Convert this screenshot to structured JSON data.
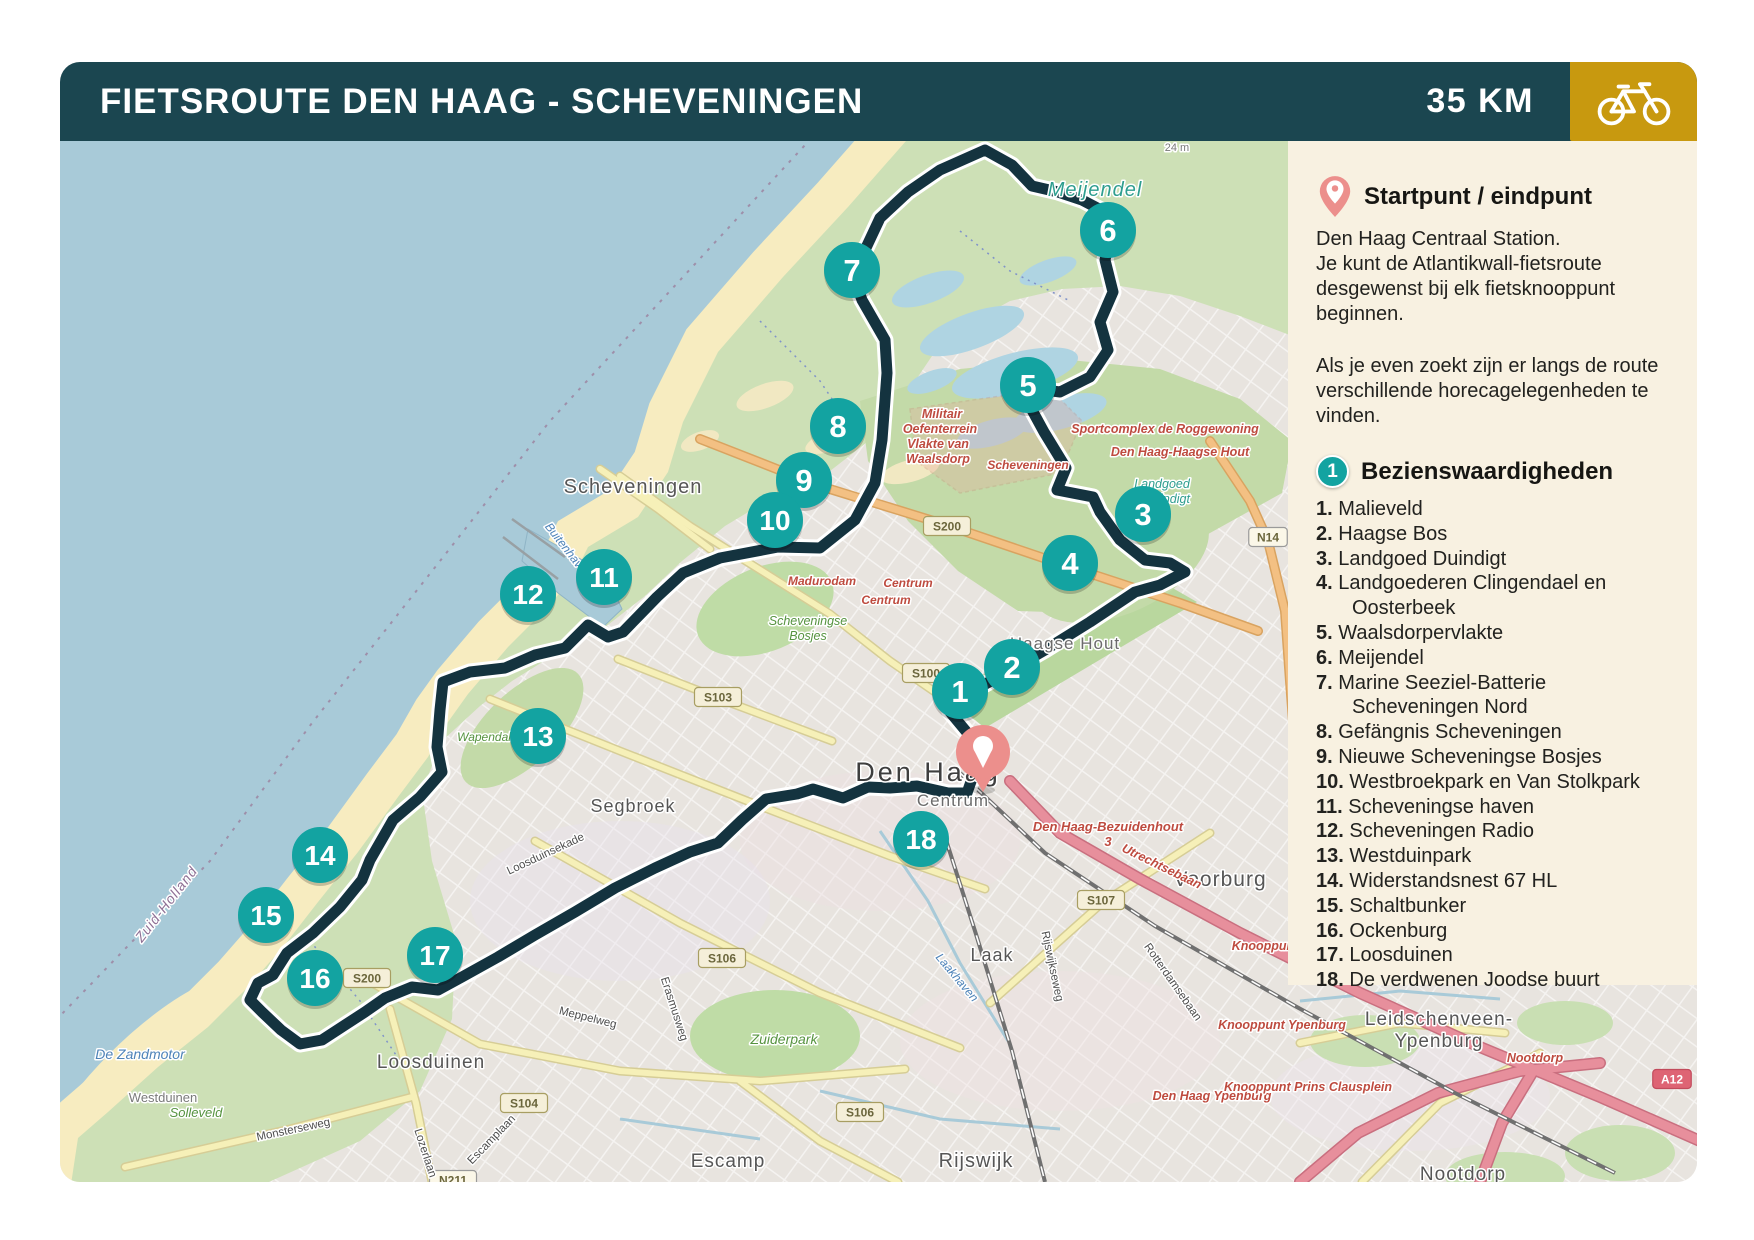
{
  "colors": {
    "header_teal": "#1B4650",
    "gold": "#C8990F",
    "marker_teal": "#13A3A1",
    "pin_salmon": "#EC8F8C",
    "route_navy": "#14333F",
    "panel_cream": "#F8F1E1"
  },
  "header": {
    "title": "FIETSROUTE DEN HAAG - SCHEVENINGEN",
    "distance": "35 KM",
    "icon": "bicycle-icon"
  },
  "sidebar": {
    "start_title": "Startpunt / eindpunt",
    "start_lines": [
      "Den Haag Centraal Station.",
      "Je kunt de Atlantikwall-fietsroute desgewenst bij elk fietsknooppunt beginnen."
    ],
    "note": "Als je even zoekt zijn er langs de route verschillende horecagelegenheden te vinden.",
    "sights_badge": "1",
    "sights_title": "Bezienswaardigheden",
    "sights": [
      {
        "n": "1.",
        "t": "Malieveld"
      },
      {
        "n": "2.",
        "t": "Haagse Bos"
      },
      {
        "n": "3.",
        "t": "Landgoed Duindigt"
      },
      {
        "n": "4.",
        "t": "Landgoederen Clingendael en Oosterbeek"
      },
      {
        "n": "5.",
        "t": "Waalsdorpervlakte"
      },
      {
        "n": "6.",
        "t": "Meijendel"
      },
      {
        "n": "7.",
        "t": "Marine Seeziel-Batterie Scheveningen Nord"
      },
      {
        "n": "8.",
        "t": "Gefängnis Scheveningen"
      },
      {
        "n": "9.",
        "t": "Nieuwe Scheveningse Bosjes"
      },
      {
        "n": "10.",
        "t": "Westbroekpark en Van Stolkpark"
      },
      {
        "n": "11.",
        "t": "Scheveningse haven"
      },
      {
        "n": "12.",
        "t": "Scheveningen Radio"
      },
      {
        "n": "13.",
        "t": "Westduinpark"
      },
      {
        "n": "14.",
        "t": "Widerstandsnest 67 HL"
      },
      {
        "n": "15.",
        "t": "Schaltbunker"
      },
      {
        "n": "16.",
        "t": "Ockenburg"
      },
      {
        "n": "17.",
        "t": "Loosduinen"
      },
      {
        "n": "18.",
        "t": "De verdwenen Joodse buurt"
      }
    ]
  },
  "map": {
    "start_pin": {
      "x": 923,
      "y": 611
    },
    "route": {
      "color": "#14333F",
      "points": [
        [
          923,
          611
        ],
        [
          915,
          629
        ],
        [
          907,
          652
        ],
        [
          888,
          652
        ],
        [
          857,
          645
        ],
        [
          830,
          647
        ],
        [
          808,
          646
        ],
        [
          783,
          657
        ],
        [
          753,
          648
        ],
        [
          737,
          653
        ],
        [
          706,
          658
        ],
        [
          682,
          679
        ],
        [
          658,
          702
        ],
        [
          630,
          711
        ],
        [
          595,
          727
        ],
        [
          555,
          747
        ],
        [
          515,
          771
        ],
        [
          475,
          794
        ],
        [
          438,
          816
        ],
        [
          402,
          836
        ],
        [
          378,
          849
        ],
        [
          352,
          846
        ],
        [
          325,
          857
        ],
        [
          305,
          871
        ],
        [
          285,
          884
        ],
        [
          262,
          899
        ],
        [
          240,
          903
        ],
        [
          221,
          889
        ],
        [
          202,
          871
        ],
        [
          190,
          859
        ],
        [
          198,
          842
        ],
        [
          213,
          834
        ],
        [
          227,
          812
        ],
        [
          253,
          792
        ],
        [
          280,
          766
        ],
        [
          302,
          739
        ],
        [
          310,
          719
        ],
        [
          333,
          679
        ],
        [
          360,
          656
        ],
        [
          382,
          631
        ],
        [
          377,
          606
        ],
        [
          380,
          569
        ],
        [
          383,
          541
        ],
        [
          410,
          531
        ],
        [
          445,
          527
        ],
        [
          475,
          514
        ],
        [
          505,
          507
        ],
        [
          528,
          484
        ],
        [
          548,
          496
        ],
        [
          563,
          491
        ],
        [
          597,
          456
        ],
        [
          623,
          432
        ],
        [
          660,
          417
        ],
        [
          718,
          406
        ],
        [
          760,
          407
        ],
        [
          795,
          379
        ],
        [
          815,
          342
        ],
        [
          822,
          299
        ],
        [
          827,
          232
        ],
        [
          825,
          199
        ],
        [
          802,
          159
        ],
        [
          792,
          131
        ],
        [
          805,
          109
        ],
        [
          820,
          77
        ],
        [
          848,
          51
        ],
        [
          880,
          29
        ],
        [
          925,
          9
        ],
        [
          952,
          24
        ],
        [
          972,
          45
        ],
        [
          998,
          51
        ],
        [
          1022,
          59
        ],
        [
          1043,
          70
        ],
        [
          1052,
          87
        ],
        [
          1045,
          119
        ],
        [
          1053,
          151
        ],
        [
          1040,
          181
        ],
        [
          1048,
          209
        ],
        [
          1030,
          236
        ],
        [
          1000,
          251
        ],
        [
          970,
          247
        ],
        [
          972,
          269
        ],
        [
          984,
          291
        ],
        [
          1006,
          327
        ],
        [
          997,
          349
        ],
        [
          1033,
          356
        ],
        [
          1040,
          371
        ],
        [
          1060,
          399
        ],
        [
          1085,
          419
        ],
        [
          1110,
          422
        ],
        [
          1125,
          431
        ],
        [
          1100,
          444
        ],
        [
          1075,
          451
        ],
        [
          1030,
          481
        ],
        [
          985,
          509
        ],
        [
          940,
          535
        ],
        [
          902,
          556
        ],
        [
          890,
          571
        ],
        [
          905,
          589
        ],
        [
          923,
          611
        ]
      ]
    },
    "markers": [
      {
        "n": "1",
        "x": 900,
        "y": 550
      },
      {
        "n": "2",
        "x": 952,
        "y": 526
      },
      {
        "n": "3",
        "x": 1083,
        "y": 373
      },
      {
        "n": "4",
        "x": 1010,
        "y": 422
      },
      {
        "n": "5",
        "x": 968,
        "y": 244
      },
      {
        "n": "6",
        "x": 1048,
        "y": 89
      },
      {
        "n": "7",
        "x": 792,
        "y": 129
      },
      {
        "n": "8",
        "x": 778,
        "y": 285
      },
      {
        "n": "9",
        "x": 744,
        "y": 339
      },
      {
        "n": "10",
        "x": 715,
        "y": 379
      },
      {
        "n": "11",
        "x": 544,
        "y": 436
      },
      {
        "n": "12",
        "x": 468,
        "y": 453
      },
      {
        "n": "13",
        "x": 478,
        "y": 595
      },
      {
        "n": "14",
        "x": 260,
        "y": 714
      },
      {
        "n": "15",
        "x": 206,
        "y": 774
      },
      {
        "n": "16",
        "x": 255,
        "y": 837
      },
      {
        "n": "17",
        "x": 375,
        "y": 814
      },
      {
        "n": "18",
        "x": 861,
        "y": 698
      }
    ],
    "labels": [
      {
        "t": "24 m",
        "x": 1117,
        "y": 10,
        "c": "minor",
        "s": 11
      },
      {
        "t": "Meijendel",
        "x": 1035,
        "y": 55,
        "c": "nature",
        "s": 20
      },
      {
        "t": "Scheveningen",
        "x": 573,
        "y": 352,
        "c": "district",
        "s": 20
      },
      {
        "t": "Madurodam",
        "x": 762,
        "y": 444,
        "c": "red",
        "s": 12
      },
      {
        "t": "Centrum",
        "x": 848,
        "y": 446,
        "c": "red",
        "s": 12
      },
      {
        "t": "Centrum",
        "x": 826,
        "y": 463,
        "c": "red",
        "s": 12
      },
      {
        "t": "Scheveningen",
        "x": 968,
        "y": 328,
        "c": "red",
        "s": 12
      },
      {
        "t": "Militair",
        "x": 882,
        "y": 277,
        "c": "red",
        "s": 12.5
      },
      {
        "t": "Oefenterrein",
        "x": 880,
        "y": 292,
        "c": "red",
        "s": 12.5
      },
      {
        "t": "Vlakte van",
        "x": 878,
        "y": 307,
        "c": "red",
        "s": 12.5
      },
      {
        "t": "Waalsdorp",
        "x": 878,
        "y": 322,
        "c": "red",
        "s": 12.5
      },
      {
        "t": "Sportcomplex de Roggewoning",
        "x": 1105,
        "y": 292,
        "c": "red",
        "s": 12.5
      },
      {
        "t": "Den Haag-Haagse Hout",
        "x": 1120,
        "y": 315,
        "c": "red",
        "s": 12.5
      },
      {
        "t": "Landgoed",
        "x": 1102,
        "y": 347,
        "c": "nature2",
        "s": 12.5
      },
      {
        "t": "Duindigt",
        "x": 1107,
        "y": 362,
        "c": "nature2",
        "s": 12.5
      },
      {
        "t": "Haagse Hout",
        "x": 1005,
        "y": 508,
        "c": "district2",
        "s": 17
      },
      {
        "t": "Scheveningse",
        "x": 748,
        "y": 484,
        "c": "green",
        "s": 12.5
      },
      {
        "t": "Bosjes",
        "x": 748,
        "y": 499,
        "c": "green",
        "s": 12.5
      },
      {
        "t": "Wapendal",
        "x": 424,
        "y": 600,
        "c": "green",
        "s": 12
      },
      {
        "t": "Den Haag",
        "x": 868,
        "y": 640,
        "c": "city",
        "s": 27
      },
      {
        "t": "Centrum",
        "x": 893,
        "y": 665,
        "c": "district2",
        "s": 17
      },
      {
        "t": "Segbroek",
        "x": 573,
        "y": 671,
        "c": "district",
        "s": 18
      },
      {
        "t": "Buitenhaven",
        "x": 505,
        "y": 412,
        "c": "water",
        "s": 12,
        "r": 52
      },
      {
        "t": "Zuid-Holland",
        "x": 110,
        "y": 766,
        "c": "boundary",
        "s": 14,
        "r": -52
      },
      {
        "t": "De Zandmotor",
        "x": 80,
        "y": 918,
        "c": "water",
        "s": 14
      },
      {
        "t": "Westduinen",
        "x": 103,
        "y": 961,
        "c": "minor",
        "s": 13
      },
      {
        "t": "Solleveld",
        "x": 136,
        "y": 976,
        "c": "green",
        "s": 13
      },
      {
        "t": "Loosduinen",
        "x": 371,
        "y": 927,
        "c": "district",
        "s": 19
      },
      {
        "t": "Monsterseweg",
        "x": 234,
        "y": 992,
        "c": "street",
        "s": 11.5,
        "r": -12
      },
      {
        "t": "Lozerlaan",
        "x": 362,
        "y": 1013,
        "c": "street",
        "s": 11.5,
        "r": 72
      },
      {
        "t": "Escamplaan",
        "x": 434,
        "y": 1001,
        "c": "street",
        "s": 11.5,
        "r": -46
      },
      {
        "t": "Escamp",
        "x": 668,
        "y": 1026,
        "c": "district",
        "s": 19
      },
      {
        "t": "Zuiderpark",
        "x": 724,
        "y": 903,
        "c": "green",
        "s": 14
      },
      {
        "t": "Meppelweg",
        "x": 527,
        "y": 880,
        "c": "street",
        "s": 11.5,
        "r": 14
      },
      {
        "t": "Erasmusweg",
        "x": 611,
        "y": 869,
        "c": "street",
        "s": 11.5,
        "r": 72
      },
      {
        "t": "Loosduinsekade",
        "x": 487,
        "y": 716,
        "c": "street",
        "s": 11.5,
        "r": -25
      },
      {
        "t": "Laak",
        "x": 932,
        "y": 820,
        "c": "district",
        "s": 18
      },
      {
        "t": "Laakhaven",
        "x": 894,
        "y": 839,
        "c": "water",
        "s": 12,
        "r": 50
      },
      {
        "t": "Rijswijkseweg",
        "x": 989,
        "y": 826,
        "c": "street",
        "s": 11.5,
        "r": 78
      },
      {
        "t": "Rotterdamsebaan",
        "x": 1110,
        "y": 843,
        "c": "street",
        "s": 11.5,
        "r": 55
      },
      {
        "t": "Rijswijk",
        "x": 916,
        "y": 1026,
        "c": "district",
        "s": 20
      },
      {
        "t": "Voorburg",
        "x": 1160,
        "y": 745,
        "c": "district",
        "s": 21
      },
      {
        "t": "Den Haag-Bezuidenhout",
        "x": 1048,
        "y": 690,
        "c": "red",
        "s": 13
      },
      {
        "t": "3",
        "x": 1048,
        "y": 705,
        "c": "red",
        "s": 13
      },
      {
        "t": "Utrechtsebaan",
        "x": 1100,
        "y": 729,
        "c": "red",
        "s": 12.5,
        "r": 26
      },
      {
        "t": "Knooppunt",
        "x": 1205,
        "y": 809,
        "c": "red",
        "s": 12.5
      },
      {
        "t": "Knooppunt Ypenburg",
        "x": 1222,
        "y": 888,
        "c": "red",
        "s": 12.5
      },
      {
        "t": "Den Haag Ypenburg",
        "x": 1152,
        "y": 959,
        "c": "red",
        "s": 12.5
      },
      {
        "t": "Knooppunt Prins Clausplein",
        "x": 1248,
        "y": 950,
        "c": "red",
        "s": 12.5
      },
      {
        "t": "Leidschenveen-",
        "x": 1379,
        "y": 884,
        "c": "district",
        "s": 19
      },
      {
        "t": "Ypenburg",
        "x": 1379,
        "y": 906,
        "c": "district",
        "s": 19
      },
      {
        "t": "Nootdorp",
        "x": 1475,
        "y": 921,
        "c": "red",
        "s": 12.5
      },
      {
        "t": "Nootdorp",
        "x": 1403,
        "y": 1039,
        "c": "district",
        "s": 19
      }
    ],
    "shields": [
      {
        "t": "S200",
        "x": 887,
        "y": 385,
        "type": "s"
      },
      {
        "t": "S200",
        "x": 307,
        "y": 837,
        "type": "s"
      },
      {
        "t": "S100",
        "x": 866,
        "y": 532,
        "type": "s"
      },
      {
        "t": "S103",
        "x": 658,
        "y": 556,
        "type": "s"
      },
      {
        "t": "S104",
        "x": 464,
        "y": 962,
        "type": "s"
      },
      {
        "t": "S106",
        "x": 662,
        "y": 817,
        "type": "s"
      },
      {
        "t": "S106",
        "x": 800,
        "y": 971,
        "type": "s"
      },
      {
        "t": "S107",
        "x": 1041,
        "y": 759,
        "type": "s"
      },
      {
        "t": "N14",
        "x": 1208,
        "y": 396,
        "type": "n"
      },
      {
        "t": "N211",
        "x": 393,
        "y": 1039,
        "type": "n"
      },
      {
        "t": "A12",
        "x": 1612,
        "y": 938,
        "type": "a"
      }
    ]
  }
}
